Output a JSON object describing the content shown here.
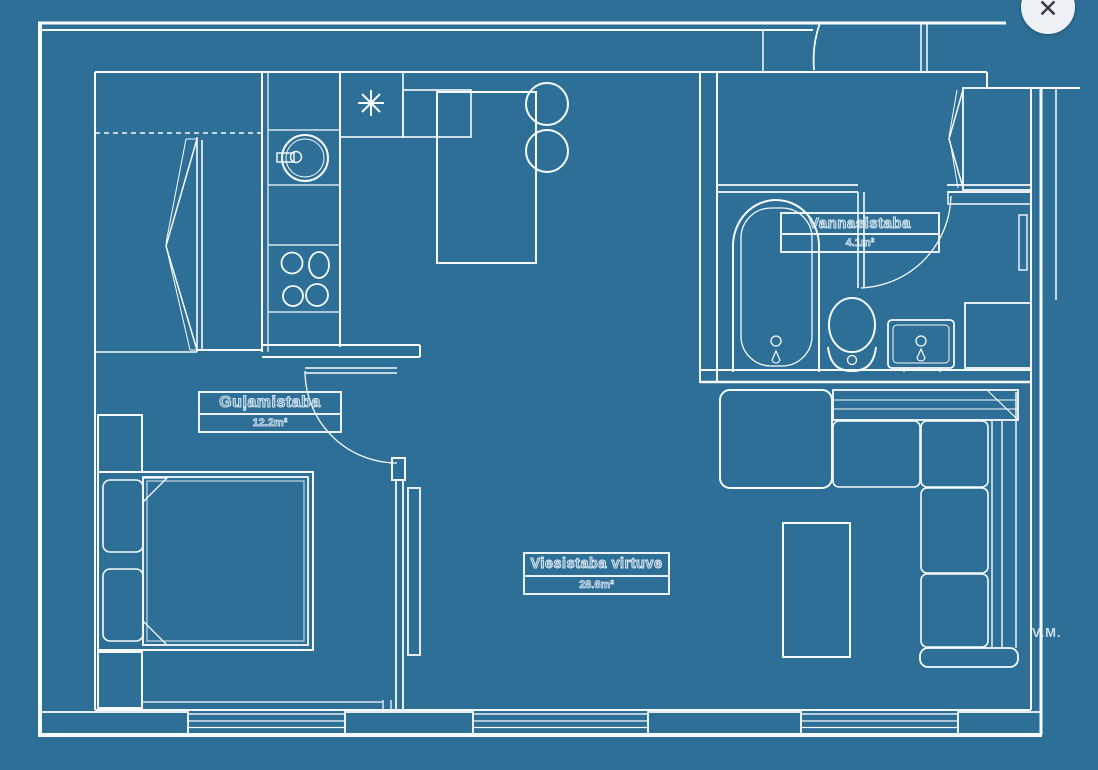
{
  "window": {
    "close_label": "✕"
  },
  "plan": {
    "rooms": [
      {
        "id": "bathroom",
        "name": "Vannasistaba",
        "area": "4.1m²"
      },
      {
        "id": "bedroom",
        "name": "Guļamistaba",
        "area": "12.2m²"
      },
      {
        "id": "living_kitchen",
        "name": "Viesistaba virtuve",
        "area": "28.6m²"
      }
    ],
    "initials": "V.M."
  },
  "colors": {
    "background": "#2d6f96",
    "line": "#f7fbfd",
    "close_bg": "#edf1f6",
    "close_x": "#343c42",
    "label_stroke": "#e4eff7"
  }
}
